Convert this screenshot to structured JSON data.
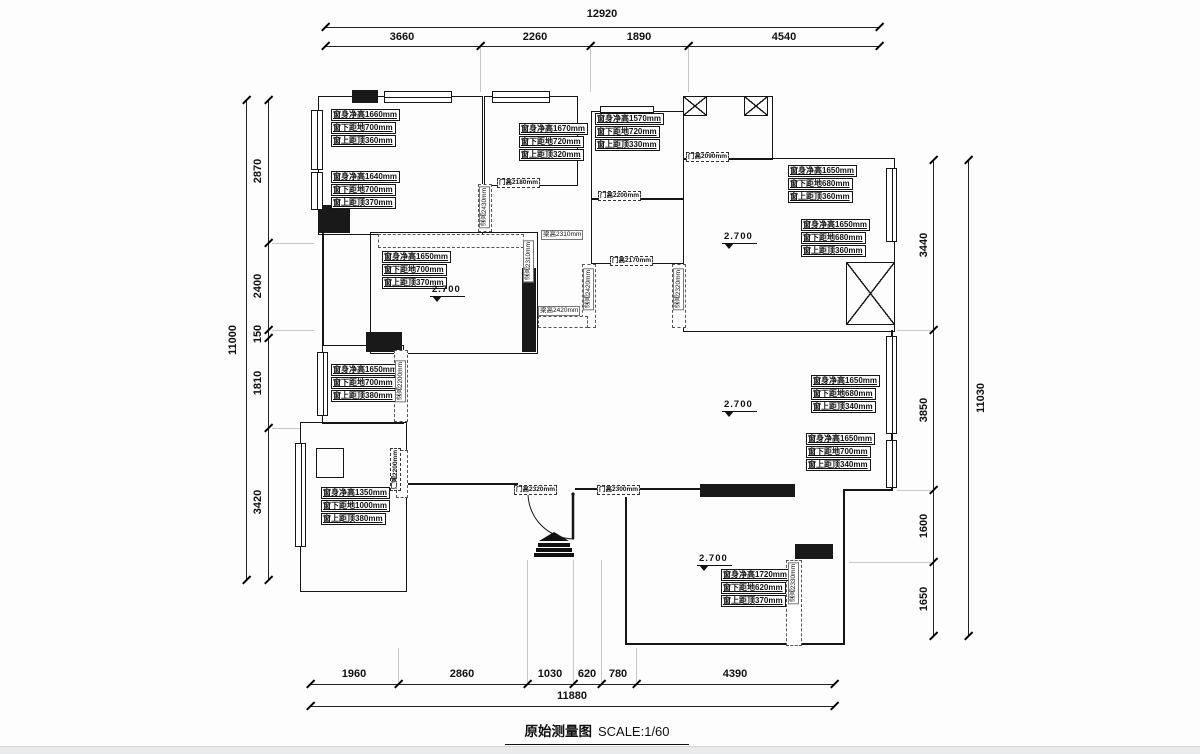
{
  "title": {
    "name": "原始测量图",
    "scale": "SCALE:1/60"
  },
  "dims": {
    "top": {
      "total": "12920",
      "segments": [
        "3660",
        "2260",
        "1890",
        "4540"
      ]
    },
    "left": {
      "total": "11000",
      "segments": [
        "2870",
        "2400",
        "150",
        "1810",
        "3420"
      ]
    },
    "right": {
      "total": "11030",
      "segments": [
        "3440",
        "3850",
        "1600",
        "1650"
      ]
    },
    "bottom": {
      "total": "11880",
      "segments": [
        "1960",
        "2860",
        "1030",
        "620",
        "780",
        "4390"
      ]
    }
  },
  "windows": [
    {
      "h": "窗身净高1660mm",
      "b": "窗下距地700mm",
      "t": "窗上距顶360mm"
    },
    {
      "h": "窗身净高1640mm",
      "b": "窗下距地700mm",
      "t": "窗上距顶370mm"
    },
    {
      "h": "窗身净高1670mm",
      "b": "窗下距地720mm",
      "t": "窗上距顶320mm"
    },
    {
      "h": "窗身净高1570mm",
      "b": "窗下距地720mm",
      "t": "窗上距顶330mm"
    },
    {
      "h": "窗身净高1650mm",
      "b": "窗下距地680mm",
      "t": "窗上距顶360mm"
    },
    {
      "h": "窗身净高1650mm",
      "b": "窗下距地680mm",
      "t": "窗上距顶360mm"
    },
    {
      "h": "窗身净高1650mm",
      "b": "窗下距地700mm",
      "t": "窗上距顶370mm"
    },
    {
      "h": "窗身净高1650mm",
      "b": "窗下距地700mm",
      "t": "窗上距顶380mm"
    },
    {
      "h": "窗身净高1650mm",
      "b": "窗下距地680mm",
      "t": "窗上距顶340mm"
    },
    {
      "h": "窗身净高1650mm",
      "b": "窗下距地700mm",
      "t": "窗上距顶340mm"
    },
    {
      "h": "窗身净高1350mm",
      "b": "窗下距地1000mm",
      "t": "窗上距顶380mm"
    },
    {
      "h": "窗身净高1720mm",
      "b": "窗下距地620mm",
      "t": "窗上距顶370mm"
    }
  ],
  "doors": [
    "门高2180mm",
    "门高2200mm",
    "门高2090mm",
    "门高2170mm",
    "门高2320mm",
    "门高2300mm",
    "门高2200mm"
  ],
  "beams": [
    "梁高2430mm",
    "梁高2310mm",
    "梁高2310mm",
    "梁高2420mm",
    "梁高2320mm",
    "梁高2420mm",
    "梁高2200mm",
    "梁高2330mm"
  ],
  "levels": [
    "2.700",
    "2.700",
    "2.700",
    "2.700"
  ]
}
